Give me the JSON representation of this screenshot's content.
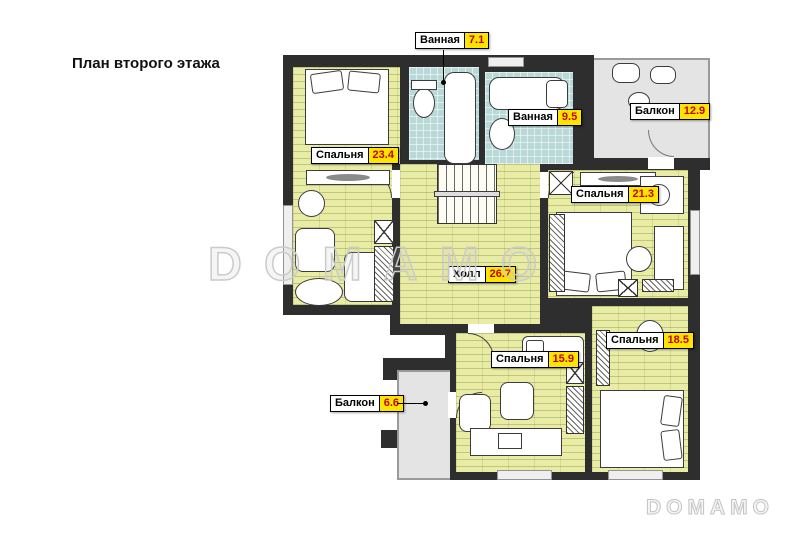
{
  "title": "План второго этажа",
  "watermark": {
    "center": "DOMAMO",
    "corner": "DOMAMO"
  },
  "rooms": [
    {
      "id": "bathroom-1",
      "name": "Ванная",
      "area": "7.1"
    },
    {
      "id": "bathroom-2",
      "name": "Ванная",
      "area": "9.5"
    },
    {
      "id": "balcony-1",
      "name": "Балкон",
      "area": "12.9"
    },
    {
      "id": "bedroom-1",
      "name": "Спальня",
      "area": "23.4"
    },
    {
      "id": "bedroom-2",
      "name": "Спальня",
      "area": "21.3"
    },
    {
      "id": "hall",
      "name": "Холл",
      "area": "26.7"
    },
    {
      "id": "bedroom-3",
      "name": "Спальня",
      "area": "15.9"
    },
    {
      "id": "bedroom-4",
      "name": "Спальня",
      "area": "18.5"
    },
    {
      "id": "balcony-2",
      "name": "Балкон",
      "area": "6.6"
    }
  ],
  "colors": {
    "wall": "#2e2e2e",
    "parquet_floor": "#e9eca4",
    "tile_floor": "#b9d8d8",
    "balcony_floor": "#e4e4e4",
    "label_area_bg": "#ffe400",
    "label_area_text": "#c40000",
    "watermark": "#cbcbcb"
  }
}
